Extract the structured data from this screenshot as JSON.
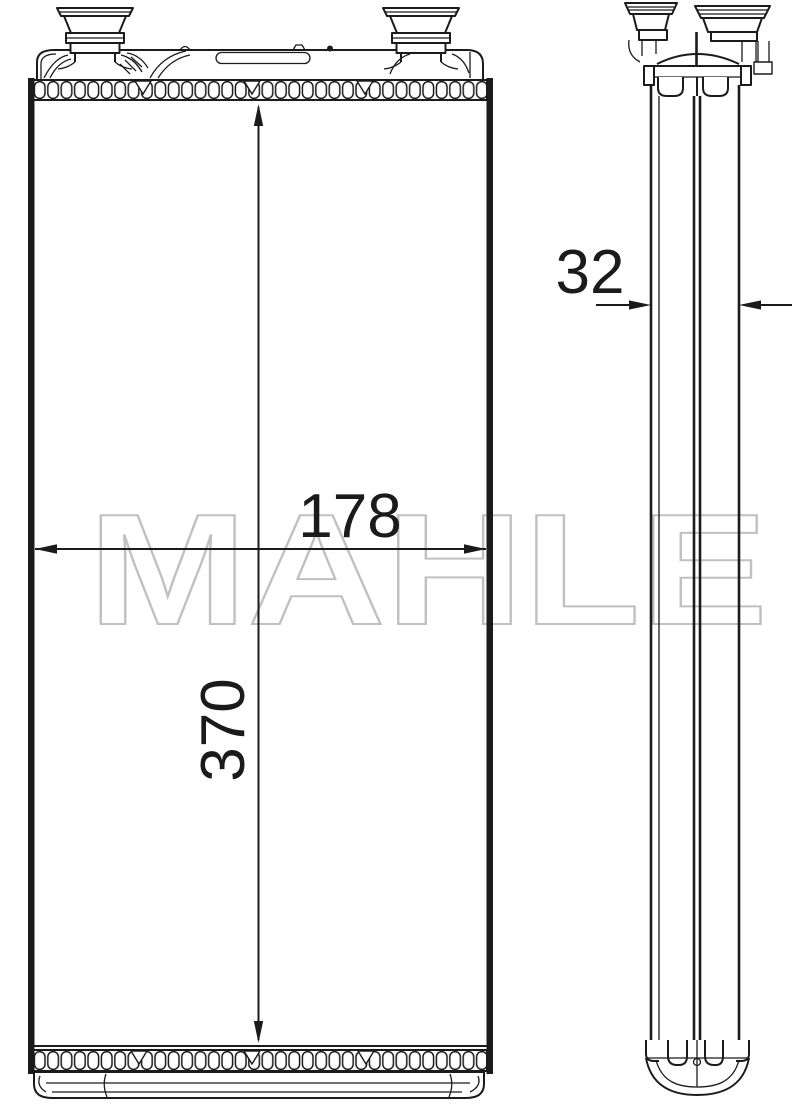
{
  "drawing": {
    "watermark": "MAHLE",
    "dimensions": {
      "core_width": "178",
      "core_height": "370",
      "core_depth": "32"
    },
    "colors": {
      "line": "#1b1b1b",
      "watermark": "#c0c0c0",
      "background": "#ffffff"
    }
  }
}
